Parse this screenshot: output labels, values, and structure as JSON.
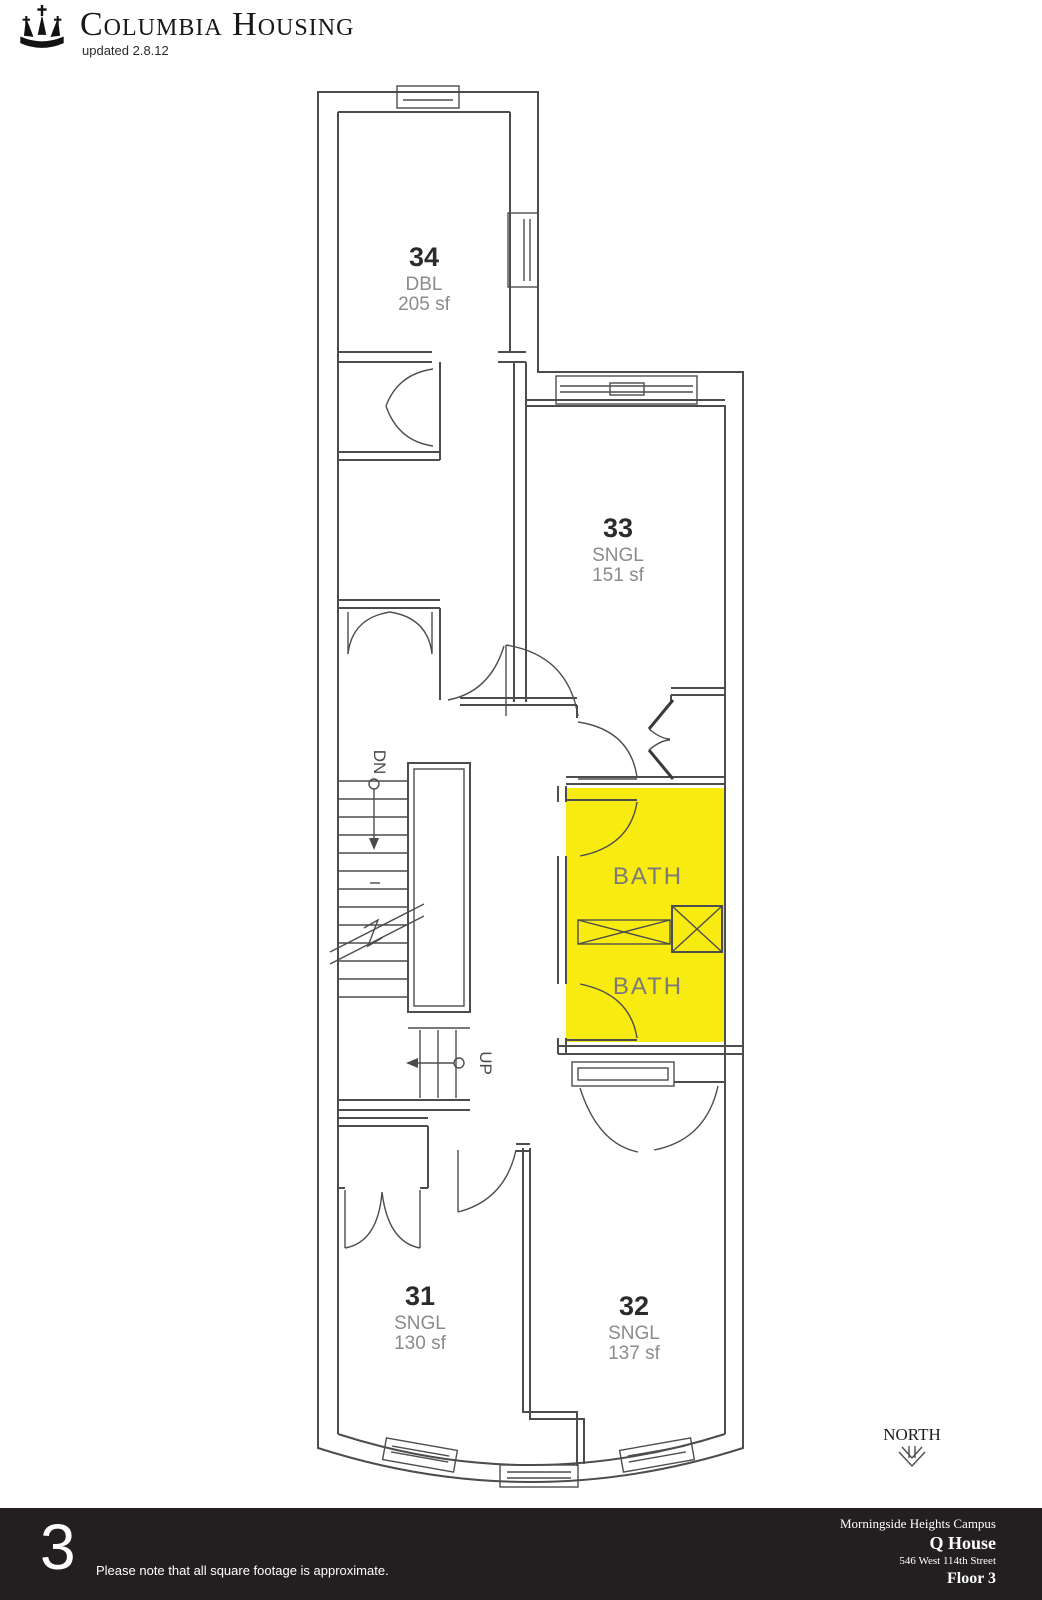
{
  "header": {
    "brand": "Columbia Housing",
    "updated": "updated 2.8.12"
  },
  "plan": {
    "highlight_color": "#F8EB12",
    "wall_color": "#4d4d4d",
    "rooms": [
      {
        "number": "34",
        "type": "DBL",
        "area": "205 sf"
      },
      {
        "number": "33",
        "type": "SNGL",
        "area": "151 sf"
      },
      {
        "number": "31",
        "type": "SNGL",
        "area": "130 sf"
      },
      {
        "number": "32",
        "type": "SNGL",
        "area": "137 sf"
      }
    ],
    "baths": {
      "top": "BATH",
      "bottom": "BATH"
    },
    "stairs": {
      "down": "DN",
      "up": "UP"
    },
    "compass": {
      "label": "NORTH",
      "direction": "down"
    }
  },
  "footer": {
    "floor_number_large": "3",
    "note": "Please note that all square footage is approximate.",
    "campus": "Morningside Heights Campus",
    "building": "Q House",
    "address": "546 West 114th Street",
    "floor": "Floor 3"
  }
}
